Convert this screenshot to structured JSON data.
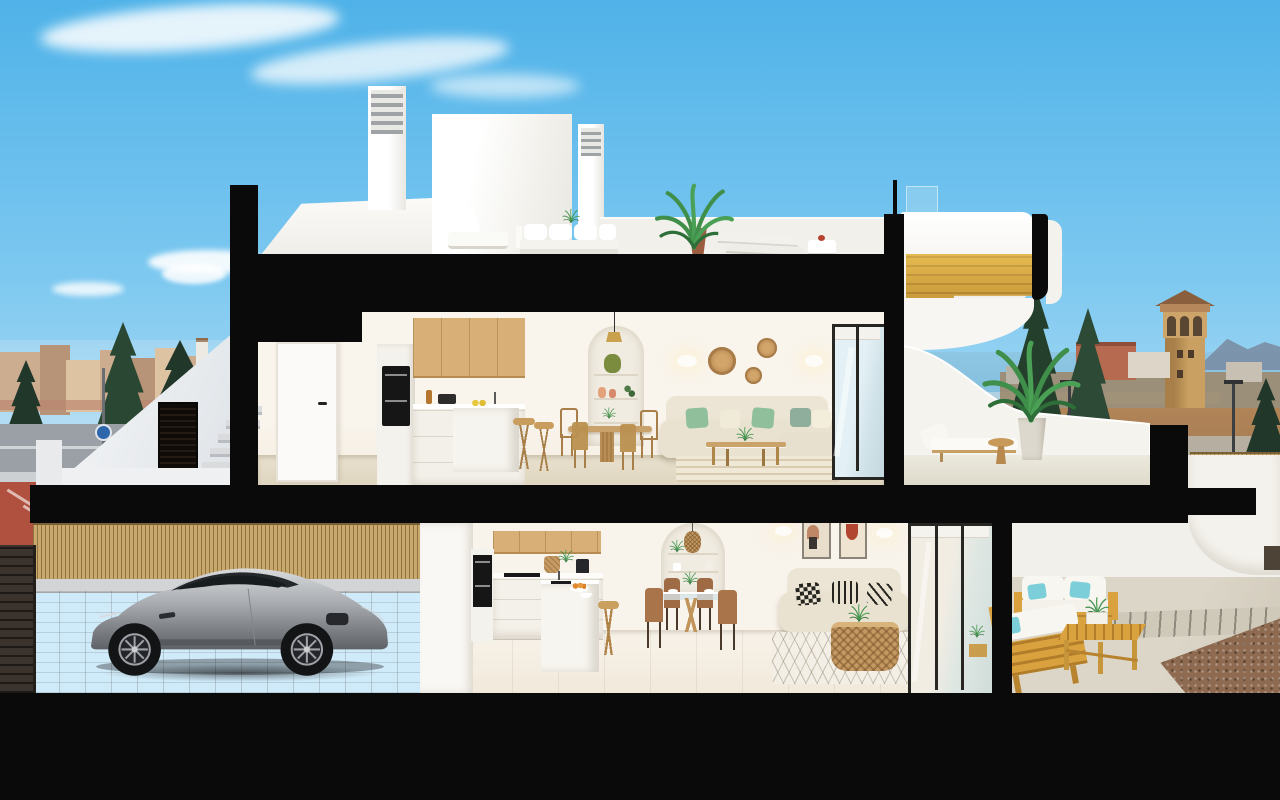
{
  "palette": {
    "sky-top": "#4fb2e8",
    "sky-mid": "#7cc8f0",
    "sky-low": "#cfeaf8",
    "cloud": "#ffffff",
    "cut": "#0a0a0b",
    "wall": "#f2f0ea",
    "wall-bright": "#fcfbf8",
    "wall-shade": "#e3e2dc",
    "interior": "#f8f3ea",
    "floor-up": "#e9e2cf",
    "floor-low": "#e4dcc9",
    "wood": "#d8b077",
    "wood-dark": "#b98c52",
    "wood-stair": "#d9a93f",
    "oven": "#161616",
    "sofa": "#e9e2d1",
    "pillow-green": "#8fbf9b",
    "pillow-teal": "#7ccfd8",
    "rattan": "#c49a62",
    "glass": "#d8e9f0",
    "frame": "#282623",
    "sea": "#7fbbdc",
    "mountain": "#7b91a8",
    "town": "#c49a74",
    "town-light": "#dcb78c",
    "town-dark": "#a97a54",
    "tree": "#2a4733",
    "tree-dark": "#20372a",
    "dirt": "#aa8157",
    "road": "#9aa0a5",
    "path-red": "#b0513f",
    "kerb": "#cdd0d2",
    "garage-floor": "#b4b6ba",
    "bamboo": "#c9a86b",
    "door-brown": "#3b342e",
    "car-silver": "#aeb1b5",
    "concrete": "#dcd6c8",
    "gravel": "#8d6a50",
    "patio-wood": "#d9a23f",
    "white-furn": "#f6f5f1",
    "art-red": "#b2452f",
    "art-tan": "#bf8766"
  },
  "scene": {
    "type": "3d-architectural-cutaway-render",
    "subject": "Cross-section of a modern two-storey Mediterranean villa, sectioned walls and slabs shown solid black",
    "sky": "clear blue sky with thin wispy clouds",
    "background_left": [
      "low-rise town skyline",
      "dark green trees",
      "grey road",
      "red bike path with white markings",
      "street lamp with round blue sign"
    ],
    "background_right": [
      "sea horizon with distant shoreline",
      "hazy mountains",
      "stone watchtower",
      "tall pine trees",
      "terracotta buildings",
      "dirt field with road",
      "twin street lamps",
      "wood slat fence"
    ],
    "roof_terrace": [
      "two white chimneys with louvre vents",
      "white stair bulkhead",
      "white parapet",
      "white outdoor sofa and lounge chairs",
      "sun loungers",
      "potted palm plants",
      "small table with red dessert",
      "glass balustrade"
    ],
    "upper_floor": [
      "white interior door with black handle",
      "light-wood upper kitchen cabinets",
      "black built-in oven",
      "white kitchen island with faucet and lemons",
      "two wooden bar stools",
      "round wooden dining table with four chairs",
      "brass pendant light",
      "arched shelf niche with vases and plant",
      "two glowing wall sconces",
      "three round wicker wall baskets",
      "beige corner sofa with green and cream pillows",
      "wood-and-glass coffee table",
      "striped beige rug",
      "dark-framed sliding glass door",
      "covered terrace with white sun lounger, round side table and potted palm",
      "sectioned golden wood staircase in curved white enclosure"
    ],
    "lower_floor": [
      "open carport with silver sports coupe",
      "bamboo slat fence",
      "dark brown garage door",
      "grey paver floor",
      "light-wood kitchen cabinets",
      "black double-oven column",
      "white island with sink, oranges and bowl",
      "wooden stool",
      "glass dining table with four brown chairs",
      "arched niche with rattan pendant and plants",
      "two abstract framed artworks",
      "two glowing wall sconces",
      "beige sofa with black-and-white patterned pillows",
      "rattan basket coffee table with plant",
      "white diamond-pattern rug",
      "dark-framed sliding glass doors",
      "patio with wooden outdoor sofas, white cushions, teal pillows, slatted wood table with planter",
      "poured concrete patio floor",
      "wood plank strip",
      "brown gravel bed",
      "white curved garden walls with small dark doorway"
    ],
    "structure": [
      "black sectioned slabs and walls",
      "black vertical wall cuts",
      "full-width black base plinth"
    ]
  }
}
